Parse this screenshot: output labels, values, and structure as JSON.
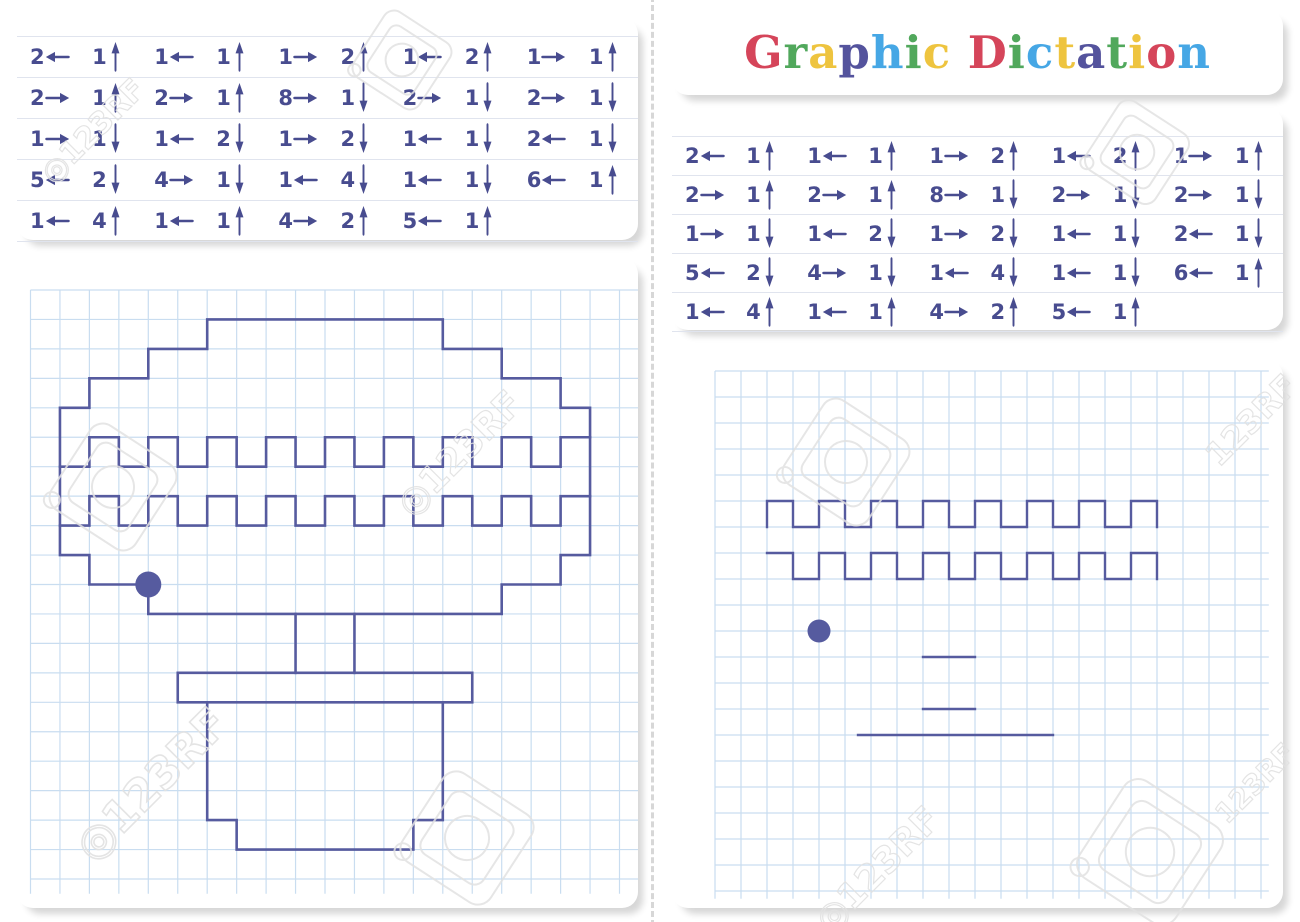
{
  "title": {
    "text": "Graphic Dictation",
    "letters": [
      [
        "G",
        "#d5455a"
      ],
      [
        "r",
        "#51a85c"
      ],
      [
        "a",
        "#eec43f"
      ],
      [
        "p",
        "#54539d"
      ],
      [
        "h",
        "#46a7e5"
      ],
      [
        "i",
        "#51a85c"
      ],
      [
        "c",
        "#eec43f"
      ],
      [
        " ",
        ""
      ],
      [
        "D",
        "#d5455a"
      ],
      [
        "i",
        "#51a85c"
      ],
      [
        "c",
        "#46a7e5"
      ],
      [
        "t",
        "#eec43f"
      ],
      [
        "a",
        "#54539d"
      ],
      [
        "t",
        "#51a85c"
      ],
      [
        "i",
        "#eec43f"
      ],
      [
        "o",
        "#d5455a"
      ],
      [
        "n",
        "#46a7e5"
      ]
    ]
  },
  "colors": {
    "ink": "#484c8f",
    "line": "#565b9f",
    "grid": "#c9ddf0",
    "rule": "#e0e4ee",
    "watermark": "#e2e2e2"
  },
  "instructions": {
    "rows": [
      [
        [
          2,
          "left"
        ],
        [
          1,
          "up"
        ],
        [
          1,
          "left"
        ],
        [
          1,
          "up"
        ],
        [
          1,
          "right"
        ],
        [
          2,
          "up"
        ],
        [
          1,
          "left"
        ],
        [
          2,
          "up"
        ],
        [
          1,
          "right"
        ],
        [
          1,
          "up"
        ]
      ],
      [
        [
          2,
          "right"
        ],
        [
          1,
          "up"
        ],
        [
          2,
          "right"
        ],
        [
          1,
          "up"
        ],
        [
          8,
          "right"
        ],
        [
          1,
          "down"
        ],
        [
          2,
          "right"
        ],
        [
          1,
          "down"
        ],
        [
          2,
          "right"
        ],
        [
          1,
          "down"
        ]
      ],
      [
        [
          1,
          "right"
        ],
        [
          1,
          "down"
        ],
        [
          1,
          "left"
        ],
        [
          2,
          "down"
        ],
        [
          1,
          "right"
        ],
        [
          2,
          "down"
        ],
        [
          1,
          "left"
        ],
        [
          1,
          "down"
        ],
        [
          2,
          "left"
        ],
        [
          1,
          "down"
        ]
      ],
      [
        [
          5,
          "left"
        ],
        [
          2,
          "down"
        ],
        [
          4,
          "right"
        ],
        [
          1,
          "down"
        ],
        [
          1,
          "left"
        ],
        [
          4,
          "down"
        ],
        [
          1,
          "left"
        ],
        [
          1,
          "down"
        ],
        [
          6,
          "left"
        ],
        [
          1,
          "up"
        ]
      ],
      [
        [
          1,
          "left"
        ],
        [
          4,
          "up"
        ],
        [
          1,
          "left"
        ],
        [
          1,
          "up"
        ],
        [
          4,
          "right"
        ],
        [
          2,
          "up"
        ],
        [
          5,
          "left"
        ],
        [
          1,
          "up"
        ]
      ]
    ]
  },
  "left_grid": {
    "cell": 29.45,
    "origin": [
      13.5,
      32
    ],
    "cols": 20.7,
    "rows": 20.5,
    "stroke": "#565b9f",
    "lw": 2.6,
    "dot": [
      4,
      10
    ],
    "dot_r": 13,
    "outline": [
      [
        6,
        1
      ],
      [
        14,
        1
      ],
      [
        14,
        2
      ],
      [
        16,
        2
      ],
      [
        16,
        3
      ],
      [
        18,
        3
      ],
      [
        18,
        4
      ],
      [
        19,
        4
      ],
      [
        19,
        9
      ],
      [
        18,
        9
      ],
      [
        18,
        10
      ],
      [
        16,
        10
      ],
      [
        16,
        11
      ],
      [
        4,
        11
      ],
      [
        4,
        10
      ],
      [
        2,
        10
      ],
      [
        2,
        9
      ],
      [
        1,
        9
      ],
      [
        1,
        4
      ],
      [
        2,
        4
      ],
      [
        2,
        3
      ],
      [
        4,
        3
      ],
      [
        4,
        2
      ],
      [
        6,
        2
      ],
      [
        6,
        1
      ]
    ],
    "band_upper": [
      [
        1,
        6
      ],
      [
        2,
        6
      ],
      [
        2,
        5
      ],
      [
        3,
        5
      ],
      [
        3,
        6
      ],
      [
        4,
        6
      ],
      [
        4,
        5
      ],
      [
        5,
        5
      ],
      [
        5,
        6
      ],
      [
        6,
        6
      ],
      [
        6,
        5
      ],
      [
        7,
        5
      ],
      [
        7,
        6
      ],
      [
        8,
        6
      ],
      [
        8,
        5
      ],
      [
        9,
        5
      ],
      [
        9,
        6
      ],
      [
        10,
        6
      ],
      [
        10,
        5
      ],
      [
        11,
        5
      ],
      [
        11,
        6
      ],
      [
        12,
        6
      ],
      [
        12,
        5
      ],
      [
        13,
        5
      ],
      [
        13,
        6
      ],
      [
        14,
        6
      ],
      [
        14,
        5
      ],
      [
        15,
        5
      ],
      [
        15,
        6
      ],
      [
        16,
        6
      ],
      [
        16,
        5
      ],
      [
        17,
        5
      ],
      [
        17,
        6
      ],
      [
        18,
        6
      ],
      [
        18,
        5
      ],
      [
        19,
        5
      ]
    ],
    "band_lower": [
      [
        1,
        8
      ],
      [
        2,
        8
      ],
      [
        2,
        7
      ],
      [
        3,
        7
      ],
      [
        3,
        8
      ],
      [
        4,
        8
      ],
      [
        4,
        7
      ],
      [
        5,
        7
      ],
      [
        5,
        8
      ],
      [
        6,
        8
      ],
      [
        6,
        7
      ],
      [
        7,
        7
      ],
      [
        7,
        8
      ],
      [
        8,
        8
      ],
      [
        8,
        7
      ],
      [
        9,
        7
      ],
      [
        9,
        8
      ],
      [
        10,
        8
      ],
      [
        10,
        7
      ],
      [
        11,
        7
      ],
      [
        11,
        8
      ],
      [
        12,
        8
      ],
      [
        12,
        7
      ],
      [
        13,
        7
      ],
      [
        13,
        8
      ],
      [
        14,
        8
      ],
      [
        14,
        7
      ],
      [
        15,
        7
      ],
      [
        15,
        8
      ],
      [
        16,
        8
      ],
      [
        16,
        7
      ],
      [
        17,
        7
      ],
      [
        17,
        8
      ],
      [
        18,
        8
      ],
      [
        18,
        7
      ],
      [
        19,
        7
      ]
    ],
    "segments": [
      [
        [
          9,
          11
        ],
        [
          9,
          13
        ]
      ],
      [
        [
          11,
          11
        ],
        [
          11,
          13
        ]
      ]
    ],
    "plate": [
      [
        5,
        13
      ],
      [
        15,
        13
      ],
      [
        15,
        14
      ],
      [
        5,
        14
      ],
      [
        5,
        13
      ]
    ],
    "pot": [
      [
        6,
        14
      ],
      [
        6,
        18
      ],
      [
        7,
        18
      ],
      [
        7,
        19
      ],
      [
        13,
        19
      ],
      [
        13,
        18
      ],
      [
        14,
        18
      ],
      [
        14,
        14
      ]
    ]
  },
  "right_grid": {
    "cell": 26,
    "origin": [
      43,
      11
    ],
    "cols": 21.3,
    "rows": 20.3,
    "stroke": "#565b9f",
    "lw": 2.4,
    "dot": [
      4,
      10
    ],
    "dot_r": 11.5,
    "band_upper": [
      [
        2,
        6
      ],
      [
        2,
        5
      ],
      [
        3,
        5
      ],
      [
        3,
        6
      ],
      [
        4,
        6
      ],
      [
        4,
        5
      ],
      [
        5,
        5
      ],
      [
        5,
        6
      ],
      [
        6,
        6
      ],
      [
        6,
        5
      ],
      [
        7,
        5
      ],
      [
        7,
        6
      ],
      [
        8,
        6
      ],
      [
        8,
        5
      ],
      [
        9,
        5
      ],
      [
        9,
        6
      ],
      [
        10,
        6
      ],
      [
        10,
        5
      ],
      [
        11,
        5
      ],
      [
        11,
        6
      ],
      [
        12,
        6
      ],
      [
        12,
        5
      ],
      [
        13,
        5
      ],
      [
        13,
        6
      ],
      [
        14,
        6
      ],
      [
        14,
        5
      ],
      [
        15,
        5
      ],
      [
        15,
        6
      ],
      [
        16,
        6
      ],
      [
        16,
        5
      ],
      [
        17,
        5
      ],
      [
        17,
        6
      ]
    ],
    "band_lower": [
      [
        2,
        7
      ],
      [
        3,
        7
      ],
      [
        3,
        8
      ],
      [
        4,
        8
      ],
      [
        4,
        7
      ],
      [
        5,
        7
      ],
      [
        5,
        8
      ],
      [
        6,
        8
      ],
      [
        6,
        7
      ],
      [
        7,
        7
      ],
      [
        7,
        8
      ],
      [
        8,
        8
      ],
      [
        8,
        7
      ],
      [
        9,
        7
      ],
      [
        9,
        8
      ],
      [
        10,
        8
      ],
      [
        10,
        7
      ],
      [
        11,
        7
      ],
      [
        11,
        8
      ],
      [
        12,
        8
      ],
      [
        12,
        7
      ],
      [
        13,
        7
      ],
      [
        13,
        8
      ],
      [
        14,
        8
      ],
      [
        14,
        7
      ],
      [
        15,
        7
      ],
      [
        15,
        8
      ],
      [
        16,
        8
      ],
      [
        16,
        7
      ],
      [
        17,
        7
      ],
      [
        17,
        8
      ]
    ],
    "segments": [
      [
        [
          8,
          11
        ],
        [
          10,
          11
        ]
      ],
      [
        [
          8,
          13
        ],
        [
          10,
          13
        ]
      ],
      [
        [
          5.5,
          14
        ],
        [
          13,
          14
        ]
      ]
    ]
  },
  "watermarks": {
    "texts": [
      {
        "text": "◎123RF",
        "x": 100,
        "y": 138,
        "size": 30,
        "rot": -45
      },
      {
        "text": "◎123RF",
        "x": 468,
        "y": 462,
        "size": 36,
        "rot": -45
      },
      {
        "text": "◎123RF",
        "x": 162,
        "y": 795,
        "size": 44,
        "rot": -45
      },
      {
        "text": "◎123RF",
        "x": 886,
        "y": 878,
        "size": 36,
        "rot": -45
      },
      {
        "text": "123RF",
        "x": 1259,
        "y": 428,
        "size": 32,
        "rot": -45
      },
      {
        "text": "123RF",
        "x": 1262,
        "y": 790,
        "size": 28,
        "rot": -45
      }
    ],
    "tags": [
      {
        "x": 402,
        "y": 60,
        "s": 78,
        "rot": -12
      },
      {
        "x": 113,
        "y": 487,
        "s": 100,
        "rot": -12
      },
      {
        "x": 467,
        "y": 838,
        "s": 105,
        "rot": -12
      },
      {
        "x": 846,
        "y": 462,
        "s": 100,
        "rot": -12
      },
      {
        "x": 1137,
        "y": 152,
        "s": 82,
        "rot": -12
      },
      {
        "x": 1150,
        "y": 852,
        "s": 115,
        "rot": -12
      }
    ]
  }
}
